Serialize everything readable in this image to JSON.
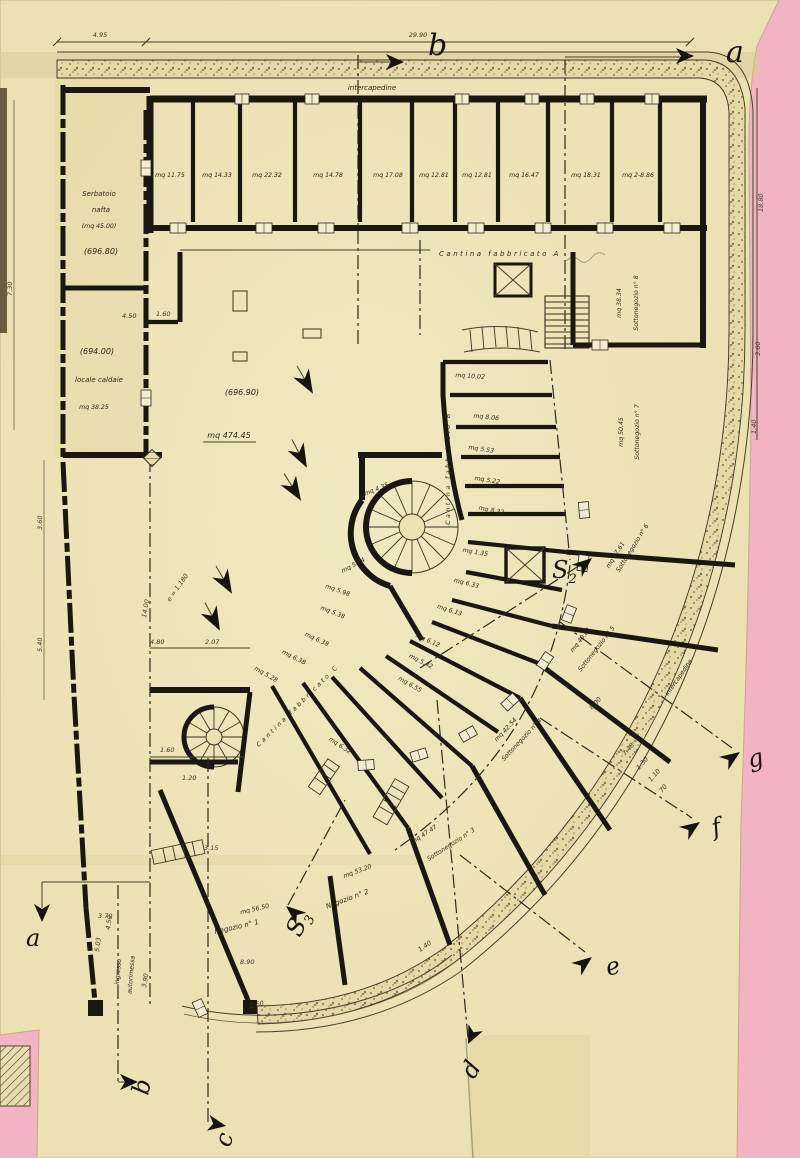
{
  "colors": {
    "background_pink": "#f2b4c4",
    "paper": "#ece1b2",
    "paper_light": "#f5eecd",
    "paper_dark": "#d9c891",
    "ink": "#1b1710",
    "stipple_base": "#e5d9a7"
  },
  "dimensions_top": {
    "left": "4.95",
    "right": "29.90"
  },
  "markers": {
    "top_b": "b",
    "top_a": "a",
    "bottom_a": "a",
    "bottom_b": "b",
    "bottom_c": "c",
    "bottom_d": "d",
    "e": "e",
    "f": "f",
    "g": "g",
    "s_letter": "S",
    "s2_sub": "2",
    "s3_sub": "3"
  },
  "perimeter": {
    "intercapedine_top": "intercapedine",
    "intercapedine_arc": "intercapedine"
  },
  "cellar_rooms": [
    "mq 11.75",
    "mq 14.33",
    "mq 22.32",
    "mq 14.78",
    "mq 17.08",
    "mq 12.81",
    "mq 12.81",
    "mq 16.47",
    "mq 18.31",
    "mq 2-8.86"
  ],
  "left_wing": {
    "serbatoio1": "Serbatoio",
    "serbatoio2": "nafta",
    "serbatoio3": "(mq 45.00)",
    "level_upper": "(696.80)",
    "level_lower": "(694.00)",
    "caldaie": "locale caldaie",
    "caldaie_area": "mq 38.25"
  },
  "hall": {
    "level": "(696.90)",
    "area": "mq 474.45",
    "cantina_a": "Cantina  fabbricato  A",
    "cantina_b": "Cantina  fabbricato  B",
    "cantina_c": "Cantina  fabbricato  C"
  },
  "shops": {
    "s8": {
      "area": "mq 38.34",
      "name": "Sottonegozio  n° 8"
    },
    "s7": {
      "area": "mq 50.45",
      "name": "Sottonegozio  n° 7"
    },
    "s6": {
      "area": "mq 47.61",
      "name": "Sottonegozio  n° 6"
    },
    "s5": {
      "area": "mq 40.61",
      "name": "Sottonegozio  n° 5"
    },
    "s4": {
      "area": "mq 42.54",
      "name": "Sottonegozio  n° 4"
    },
    "s3": {
      "area": "mq 47.47",
      "name": "Sottonegozio  n° 3"
    },
    "n2": {
      "area": "mq 53.20",
      "name": "Negozio  n° 2"
    },
    "n1": {
      "area": "mq 56.50",
      "name": "Negozio  n° 1"
    }
  },
  "small_rooms": [
    "mq 10.02",
    "mq 8.06",
    "mq 5.53",
    "mq 5.22",
    "mq 8.32",
    "mq 1.35",
    "mq 6.33",
    "mq 6.13",
    "mq 5.98",
    "mq 5.38",
    "mq 6.38",
    "mq 6.38",
    "mq 5.28",
    "mq 6.12",
    "mq 5.42",
    "mq 6.55",
    "mq 6.32",
    "mq 4.35",
    "mq 5.84"
  ],
  "ramp": {
    "line1": "ingresso",
    "line2": "autorimessa"
  },
  "dims": {
    "d450": "4.50",
    "d160": "1.60",
    "d1400": "14.00",
    "d480": "4.80",
    "d207": "2.07",
    "d160b": "1.60",
    "d120": "1.20",
    "d315": "3.15",
    "d890": "8.90",
    "d503": "5.03",
    "d390": "3.90",
    "d450b": "4.50",
    "d370": "3.70",
    "d260": "2.60",
    "d140b": "1.40",
    "d1880": "18.80",
    "d360r": "3.60",
    "d140r": "1.40",
    "d730": "7.30",
    "d360l": "3.60",
    "d540": "5.40",
    "d800": "8.00",
    "d748": "7.48",
    "d130": "1.30",
    "d110": "1.10",
    "d70": "70",
    "e_dim": "e = 1.180"
  }
}
